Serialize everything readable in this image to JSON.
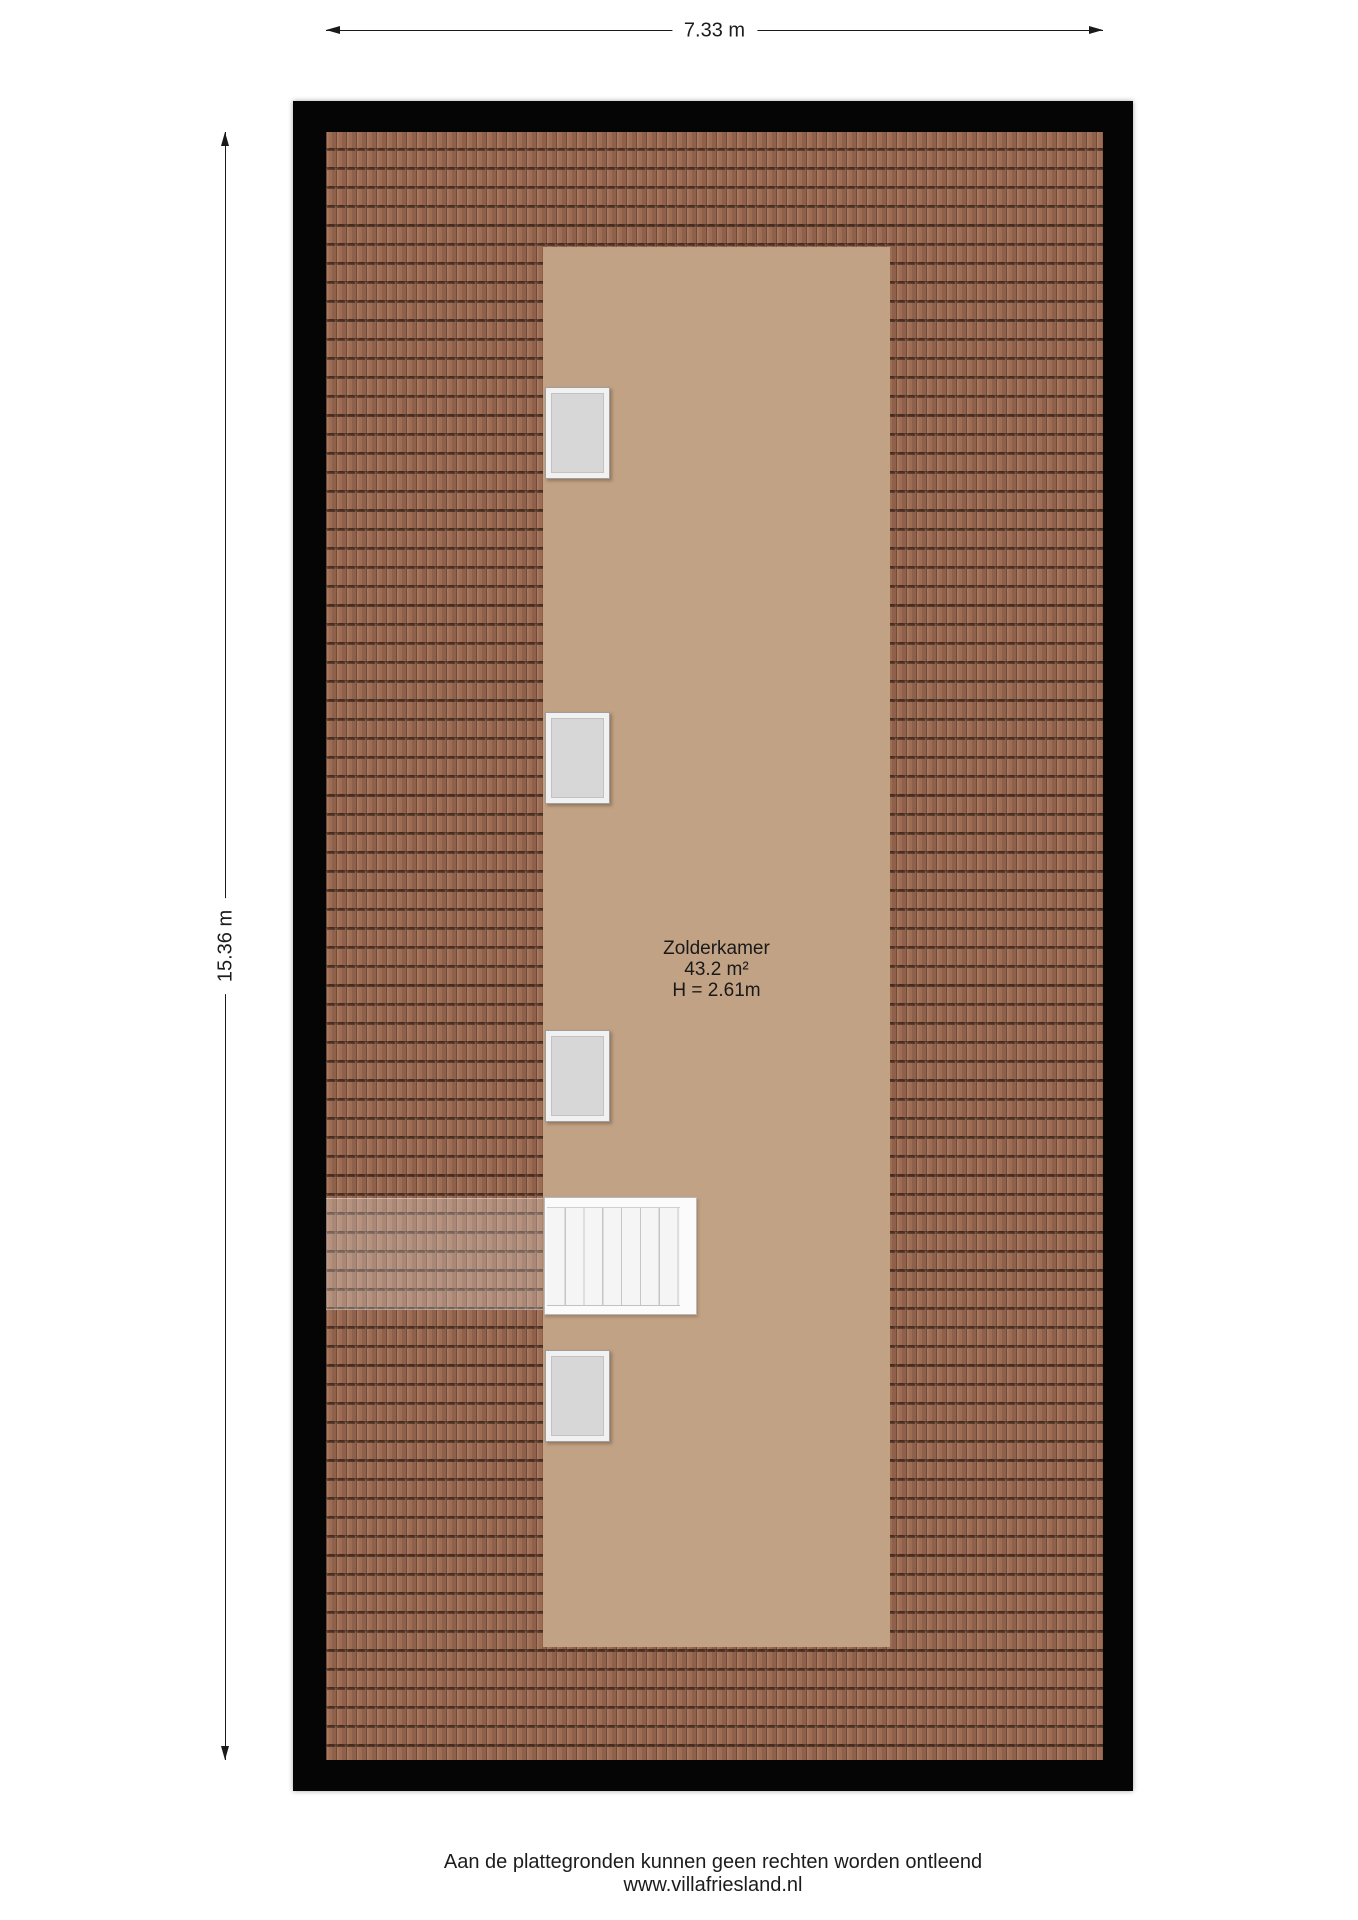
{
  "dimensions": {
    "width": "7.33 m",
    "height": "15.36 m"
  },
  "room": {
    "name": "Zolderkamer",
    "area": "43.2 m²",
    "ceiling_height": "H = 2.61m"
  },
  "plan": {
    "window_count": 4,
    "colors": {
      "wall": "#050505",
      "roof_tile": "#9d6c53",
      "roof_tile_line": "#2b160d",
      "room_floor": "#c2a284",
      "window_frame": "#f1f1f1",
      "window_pane": "#d7d7d7",
      "stairs": "#f5f5f5"
    }
  },
  "footer": {
    "disclaimer": "Aan de plattegronden kunnen geen rechten worden ontleend",
    "website": "www.villafriesland.nl"
  }
}
